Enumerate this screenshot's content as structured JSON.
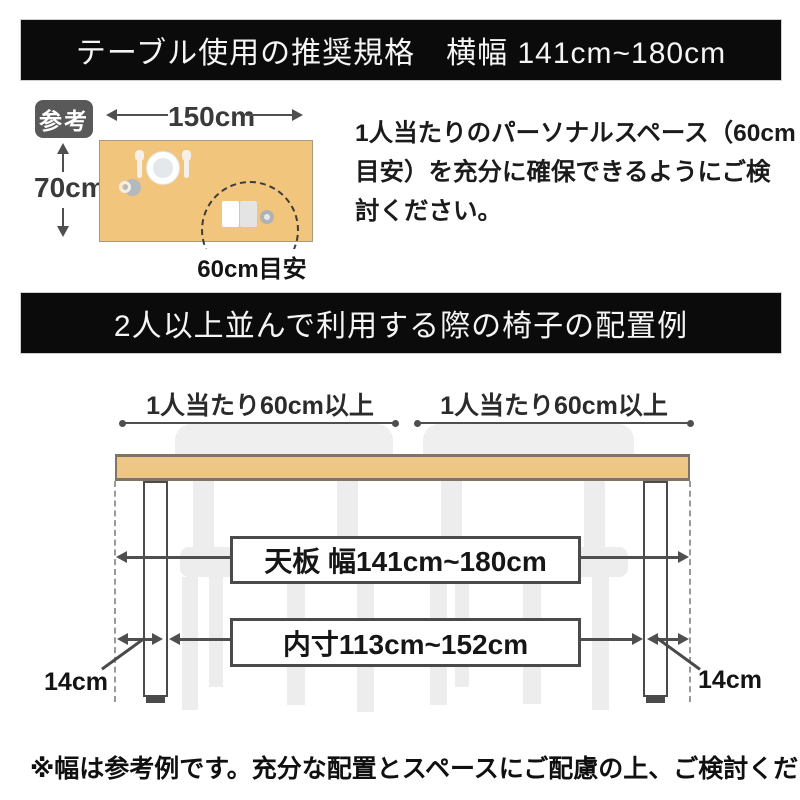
{
  "banner1": {
    "title": "テーブル使用の推奨規格　横幅 141cm~180cm"
  },
  "reference": {
    "badge": "参考",
    "width_label": "150cm",
    "depth_label": "70cm",
    "space_label": "60cm目安",
    "note_lines": [
      "1人当たりのパーソナルスペース（60cm",
      "目安）を充分に確保できるようにご検",
      "討ください。"
    ]
  },
  "banner2": {
    "title": "2人以上並んで利用する際の椅子の配置例"
  },
  "layout_diagram": {
    "per_person_left": "1人当たり60cm以上",
    "per_person_right": "1人当たり60cm以上",
    "tabletop_width": "天板 幅141cm~180cm",
    "inner_width": "内寸113cm~152cm",
    "leg_offset_left": "14cm",
    "leg_offset_right": "14cm"
  },
  "footer": {
    "note": "※幅は参考例です。充分な配置とスペースにご配慮の上、ご検討ください。"
  },
  "colors": {
    "banner_bg": "#0b0b0b",
    "banner_text": "#f5f5f5",
    "badge_bg": "#595959",
    "reference_table_fill": "#f2c57d",
    "tabletop_fill": "#eec787",
    "tabletop_border": "#7d7566",
    "chair_fill": "#ededed",
    "line": "#4f4f4f",
    "text": "#1f1f1f"
  }
}
